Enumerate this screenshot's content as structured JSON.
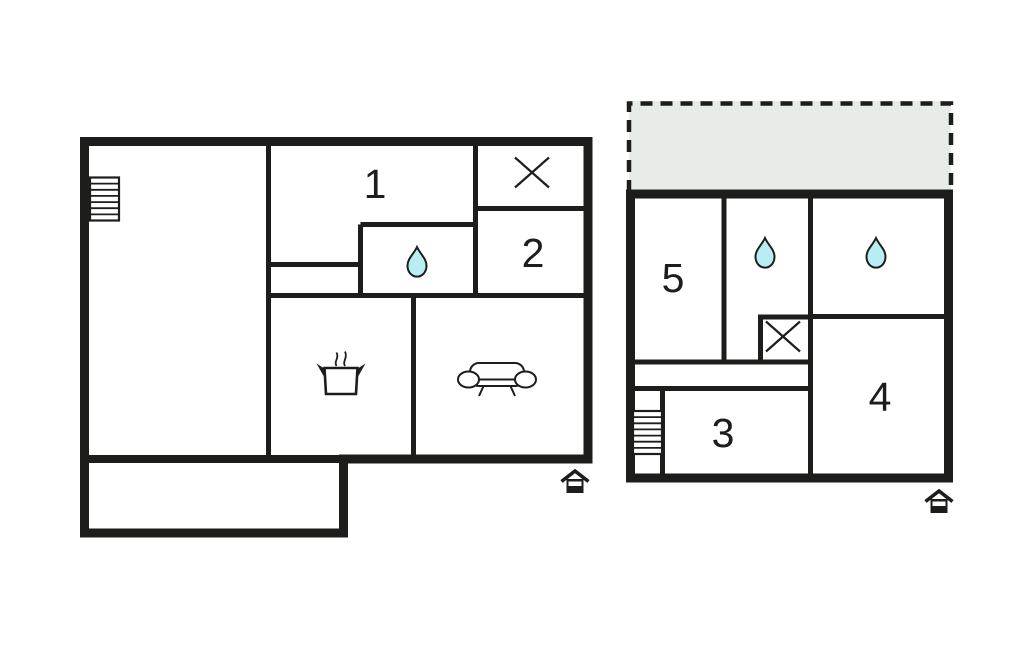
{
  "colors": {
    "wall": "#1d1d1b",
    "water_drop_fill": "#b9edf4",
    "terrace_fill": "#e8ece9",
    "background": "#ffffff"
  },
  "plans": {
    "left": {
      "rooms": [
        {
          "label": "1"
        },
        {
          "label": "2"
        }
      ],
      "icons": [
        "stairs-icon",
        "cross-icon",
        "water-drop-icon",
        "cooking-pot-icon",
        "sofa-icon",
        "house-entrance-icon"
      ]
    },
    "right": {
      "rooms": [
        {
          "label": "5"
        },
        {
          "label": "3"
        },
        {
          "label": "4"
        }
      ],
      "icons": [
        "terrace-dashed-area",
        "water-drop-icon",
        "water-drop-icon",
        "cross-icon",
        "stairs-icon",
        "house-entrance-icon"
      ]
    }
  }
}
